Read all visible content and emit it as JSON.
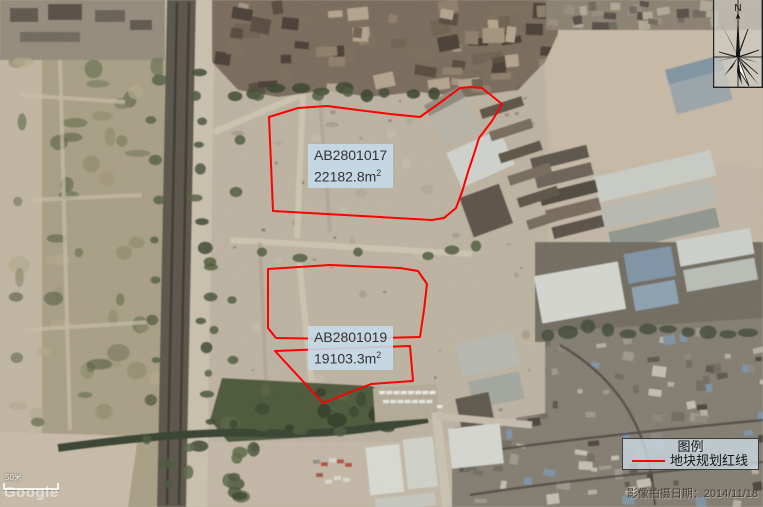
{
  "map": {
    "compass_north_label": "N",
    "scale_bar_label": "50米",
    "watermark": "Google",
    "image_date_note": "影像拍摄日期：2014/11/18"
  },
  "legend": {
    "title": "图例",
    "items": [
      {
        "symbol": "red-line",
        "label": "地块规划红线",
        "color": "#fe0000"
      }
    ]
  },
  "parcels": [
    {
      "id": "AB2801017",
      "area_value": "22182.8m",
      "area_sup": "2",
      "label_box": {
        "x": 308,
        "y": 144
      },
      "polygons": [
        [
          [
            269,
            117
          ],
          [
            298,
            108
          ],
          [
            327,
            106
          ],
          [
            358,
            110
          ],
          [
            390,
            114
          ],
          [
            420,
            117
          ],
          [
            441,
            102
          ],
          [
            460,
            88
          ],
          [
            470,
            87
          ],
          [
            482,
            88
          ],
          [
            502,
            104
          ],
          [
            492,
            121
          ],
          [
            479,
            138
          ],
          [
            474,
            154
          ],
          [
            468,
            172
          ],
          [
            462,
            192
          ],
          [
            456,
            208
          ],
          [
            444,
            218
          ],
          [
            432,
            220
          ],
          [
            273,
            211
          ]
        ]
      ]
    },
    {
      "id": "AB2801019",
      "area_value": "19103.3m",
      "area_sup": "2",
      "label_box": {
        "x": 308,
        "y": 326
      },
      "polygons": [
        [
          [
            268,
            269
          ],
          [
            330,
            265
          ],
          [
            400,
            268
          ],
          [
            418,
            271
          ],
          [
            427,
            284
          ],
          [
            424,
            310
          ],
          [
            420,
            337
          ],
          [
            340,
            339
          ],
          [
            276,
            338
          ],
          [
            268,
            328
          ]
        ],
        [
          [
            275,
            351
          ],
          [
            350,
            348
          ],
          [
            410,
            346
          ],
          [
            413,
            381
          ],
          [
            371,
            384
          ],
          [
            323,
            403
          ]
        ]
      ]
    }
  ],
  "colors": {
    "parcel_line": "#fe0000",
    "label_bg": "rgba(197,218,234,0.9)",
    "label_text": "#333333"
  }
}
